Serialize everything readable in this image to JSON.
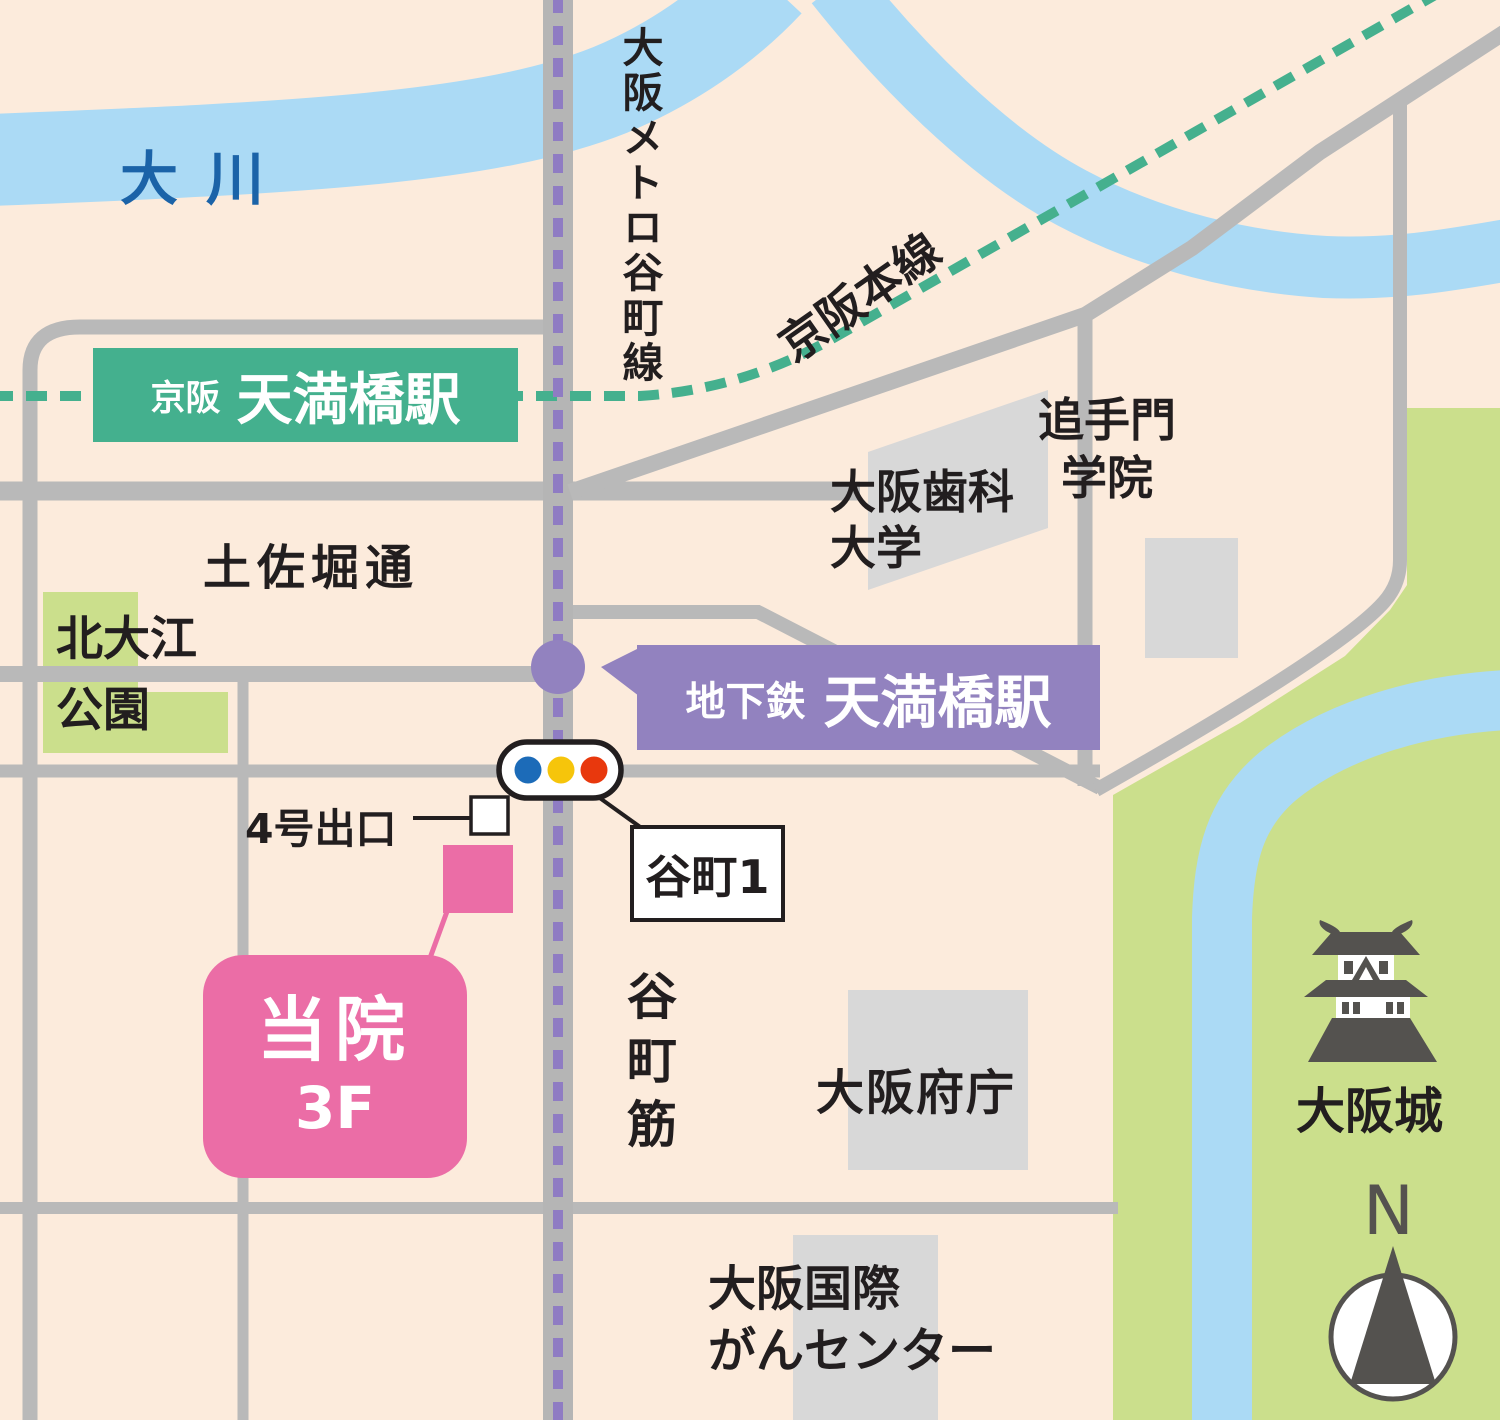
{
  "rivers": {
    "okawa": "大川"
  },
  "rail_lines": {
    "metro": "大阪メトロ谷町線",
    "keihan": "京阪本線"
  },
  "stations": {
    "keihan": {
      "company": "京阪",
      "name": "天満橋駅"
    },
    "subway": {
      "system": "地下鉄",
      "name": "天満橋駅"
    }
  },
  "roads": {
    "tosabori": "土佐堀通",
    "tanimachisuji": "谷町筋"
  },
  "places": {
    "kitaoe_park": [
      "北大江",
      "公園"
    ],
    "dental_university": [
      "大阪歯科",
      "大学"
    ],
    "otemon_gakuin": [
      "追手門",
      "学院"
    ],
    "prefectural_office": "大阪府庁",
    "cancer_center": [
      "大阪国際",
      "がんセンター"
    ],
    "osaka_castle": "大阪城"
  },
  "markers": {
    "intersection_name": "谷町1",
    "exit_name": "4号出口",
    "clinic": {
      "line1": "当院",
      "line2": "3F"
    },
    "compass": "N"
  },
  "colors": {
    "background": "#FCEBDC",
    "road_gray": "#B9B9B9",
    "building_gray": "#D8D8D8",
    "river_blue": "#ABDAF5",
    "river_text_blue": "#1B63A8",
    "keihan_green": "#45B08E",
    "park_green": "#CBDF8C",
    "metro_purple": "#8F7CC3",
    "subway_box_purple": "#9282BF",
    "clinic_pink": "#EB6DA6",
    "signal_blue": "#1C6BB8",
    "signal_yellow": "#F6C50B",
    "signal_red": "#E8380D",
    "icon_dark": "#54524F",
    "text_black": "#221E1F"
  }
}
